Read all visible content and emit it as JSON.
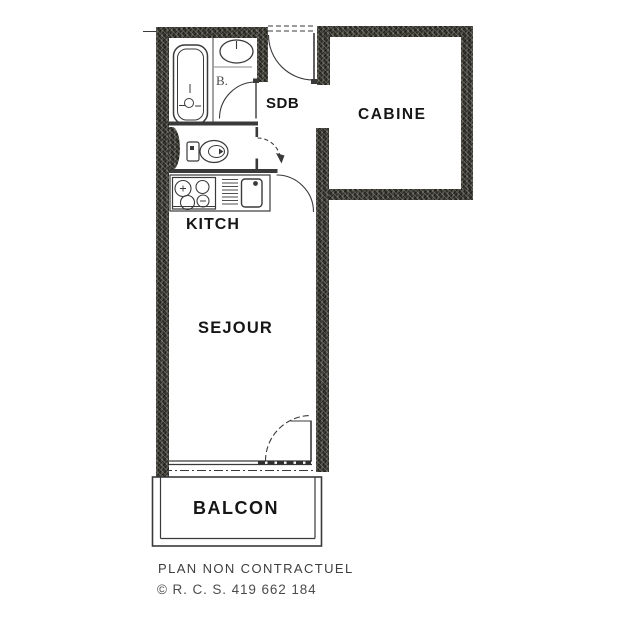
{
  "plan": {
    "rooms": [
      {
        "id": "sdb",
        "label": "SDB"
      },
      {
        "id": "cabine",
        "label": "CABINE"
      },
      {
        "id": "kitch",
        "label": "KITCH"
      },
      {
        "id": "sejour",
        "label": "SEJOUR"
      },
      {
        "id": "balcon",
        "label": "BALCON"
      }
    ],
    "bath_mark": "B.",
    "icons": {
      "bathtub": "rounded-rect-tub",
      "washbasin": "oval-basin-with-tap",
      "toilet": "tank-and-bowl",
      "stove": "four-burner-hob",
      "dish_rack": "slatted-lines",
      "kitchen_sink": "rounded-rect-basin",
      "door_swing": "quarter-arc"
    },
    "colors": {
      "background": "#ffffff",
      "wall_fill": "#45443d",
      "line": "#3a3a3a",
      "room_label": "#161616",
      "footer_text": "#434343"
    }
  },
  "footer": {
    "disclaimer": "PLAN NON CONTRACTUEL",
    "registration": "© R. C. S. 419 662 184"
  }
}
